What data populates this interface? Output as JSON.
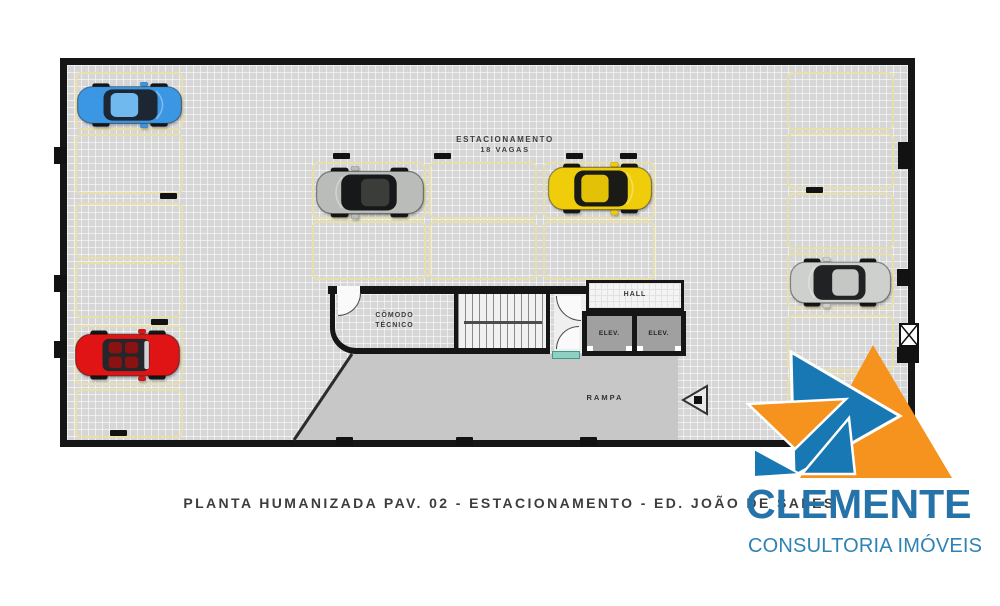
{
  "plan": {
    "area_label": {
      "line1": "ESTACIONAMENTO",
      "line2": "18 VAGAS"
    },
    "rooms": {
      "technical_room": {
        "line1": "CÔMODO",
        "line2": "TÉCNICO"
      },
      "hall": "HALL",
      "elevator_left": "ELEV.",
      "elevator_right": "ELEV.",
      "ramp": "RAMPA"
    },
    "colors": {
      "floor": "#d6d6d6",
      "wall": "#161616",
      "spot_outline": "#e9dfa9",
      "ramp": "#c7c7c7",
      "stair": "#f1f1f1",
      "elevator_cab": "#a0a0a0",
      "hall_floor": "#f4f4f4",
      "mat": "#8fd0c2"
    },
    "cars": [
      {
        "name": "blue-car",
        "variant": "coupe",
        "facing": "right",
        "body": "#3b97e3",
        "glass": "#1d2733",
        "roof": "#6fb9ef",
        "x": 76,
        "y": 82,
        "w": 107,
        "h": 46
      },
      {
        "name": "gray-car",
        "variant": "coupe",
        "facing": "left",
        "body": "#b9bcb9",
        "glass": "#17181a",
        "roof": "#3a3d3a",
        "x": 315,
        "y": 166,
        "w": 110,
        "h": 53
      },
      {
        "name": "yellow-car",
        "variant": "coupe",
        "facing": "right",
        "body": "#f0cd0a",
        "glass": "#1a1a17",
        "roof": "#e3c106",
        "x": 547,
        "y": 162,
        "w": 106,
        "h": 53
      },
      {
        "name": "silver-car",
        "variant": "coupe",
        "facing": "left",
        "body": "#cdd0cd",
        "glass": "#202224",
        "roof": "#c4c7c4",
        "x": 789,
        "y": 257,
        "w": 103,
        "h": 51
      },
      {
        "name": "red-car",
        "variant": "convertible",
        "facing": "right",
        "body": "#e01414",
        "glass": "#23262a",
        "seat": "#8a1212",
        "x": 74,
        "y": 329,
        "w": 107,
        "h": 52
      }
    ]
  },
  "caption": "PLANTA HUMANIZADA PAV. 02 - ESTACIONAMENTO - ED. JOÃO DE SALES",
  "logo": {
    "name": "CLEMENTE",
    "tagline": "CONSULTORIA IMÓVEIS",
    "colors": {
      "orange": "#f6921e",
      "blue": "#1878b4",
      "text": "#2673a9",
      "tagline_text": "#2f82b5"
    }
  }
}
